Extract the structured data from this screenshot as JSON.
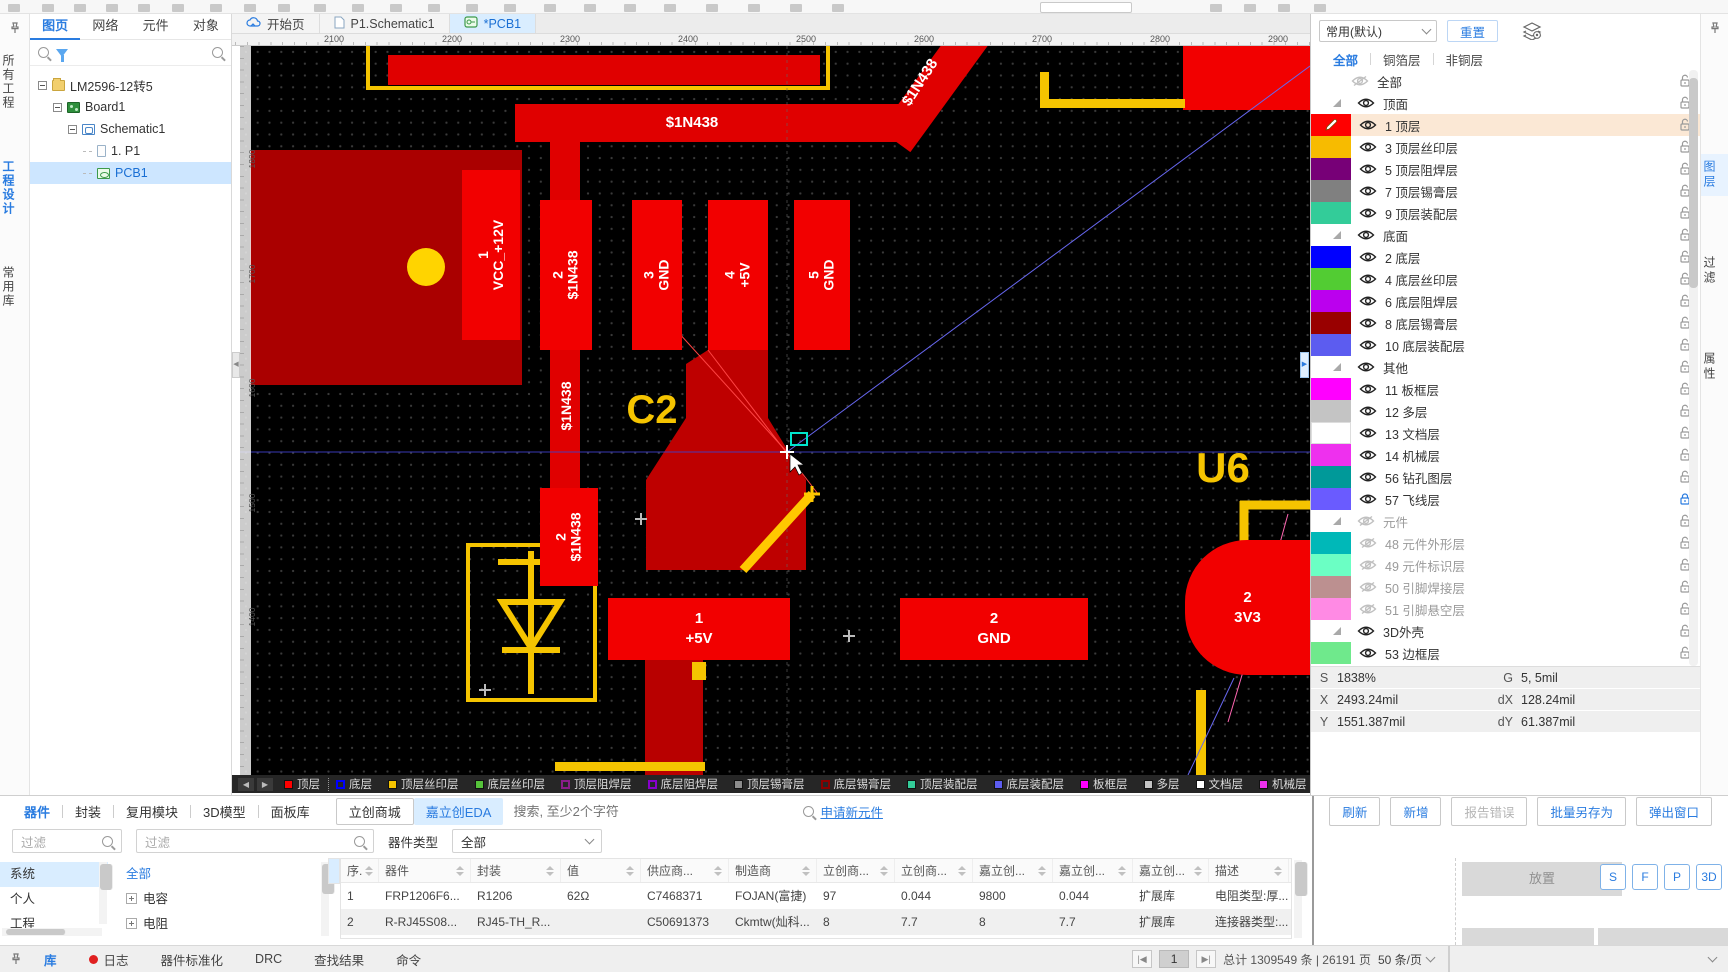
{
  "doc_tabs": [
    {
      "label": "开始页",
      "icon": "cloud-icon",
      "active": false
    },
    {
      "label": "P1.Schematic1",
      "icon": "schematic-doc-icon",
      "active": false
    },
    {
      "label": "*PCB1",
      "icon": "pcb-doc-icon",
      "active": true
    }
  ],
  "left_rail": {
    "tabs": [
      "所有工程",
      "工程设计",
      "常用库"
    ],
    "active_index": 1
  },
  "left_panel": {
    "tabs": [
      "图页",
      "网络",
      "元件",
      "对象"
    ],
    "active_tab": 0,
    "tree": [
      {
        "label": "LM2596-12转5",
        "icon": "folder",
        "indent": 0,
        "expand": true
      },
      {
        "label": "Board1",
        "icon": "board",
        "indent": 1,
        "expand": true
      },
      {
        "label": "Schematic1",
        "icon": "sch",
        "indent": 2,
        "expand": true
      },
      {
        "label": "1. P1",
        "icon": "page",
        "indent": 3,
        "expand": false
      },
      {
        "label": "PCB1",
        "icon": "pcb",
        "indent": 3,
        "expand": false,
        "selected": true
      }
    ]
  },
  "canvas": {
    "ruler_x": [
      "2100",
      "2200",
      "2300",
      "2400",
      "2500",
      "2600",
      "2700",
      "2800",
      "2900"
    ],
    "ruler_y": [
      "1800",
      "1700",
      "1600",
      "1500",
      "1400"
    ],
    "colors": {
      "copper": "#F20000",
      "pour": "#AA0000",
      "silk": "#F5C400",
      "via": "#FFD400"
    },
    "labels": [
      {
        "text": "$1N438",
        "x": 392,
        "y": 68,
        "size": 15,
        "color": "#fff",
        "rot": 0,
        "w": 120,
        "bold": true
      },
      {
        "text": "$1N438",
        "x": 630,
        "y": 28,
        "size": 15,
        "color": "#fff",
        "rot": -57,
        "w": 100,
        "bold": true
      },
      {
        "text": "$1N438",
        "x": 266,
        "y": 352,
        "size": 14,
        "color": "#fff",
        "rot": -90,
        "w": 120,
        "bold": true
      },
      {
        "text": "C2",
        "x": 372,
        "y": 342,
        "size": 40,
        "color": "#F5C400",
        "rot": 0,
        "w": 80,
        "bold": true
      },
      {
        "text": "U6",
        "x": 938,
        "y": 398,
        "size": 42,
        "color": "#F5C400",
        "rot": 0,
        "w": 90,
        "bold": true
      }
    ],
    "pads": [
      {
        "x": 222,
        "y": 124,
        "w": 58,
        "h": 170,
        "dir": "v",
        "lines": [
          "1",
          "VCC_+12V"
        ]
      },
      {
        "x": 300,
        "y": 154,
        "w": 52,
        "h": 150,
        "dir": "v",
        "lines": [
          "2",
          "$1N438"
        ]
      },
      {
        "x": 392,
        "y": 154,
        "w": 50,
        "h": 150,
        "dir": "v",
        "lines": [
          "3",
          "GND"
        ]
      },
      {
        "x": 468,
        "y": 154,
        "w": 60,
        "h": 150,
        "dir": "v",
        "lines": [
          "4",
          "+5V"
        ]
      },
      {
        "x": 554,
        "y": 154,
        "w": 56,
        "h": 150,
        "dir": "v",
        "lines": [
          "5",
          "GND"
        ]
      },
      {
        "x": 300,
        "y": 442,
        "w": 58,
        "h": 98,
        "dir": "v",
        "lines": [
          "2",
          "$1N438"
        ]
      },
      {
        "x": 368,
        "y": 552,
        "w": 182,
        "h": 62,
        "dir": "h",
        "lines": [
          "1",
          "+5V"
        ]
      },
      {
        "x": 660,
        "y": 552,
        "w": 188,
        "h": 62,
        "dir": "h",
        "lines": [
          "2",
          "GND"
        ]
      },
      {
        "x": 945,
        "y": 494,
        "w": 125,
        "h": 135,
        "dir": "h",
        "round": true,
        "lines": [
          "2",
          "3V3"
        ]
      }
    ],
    "layer_chips": [
      {
        "label": "顶层",
        "color": "#FF0000",
        "hollow": false,
        "active": true
      },
      {
        "label": "底层",
        "color": "#0000FF",
        "hollow": true,
        "active": false
      },
      {
        "label": "顶层丝印层",
        "color": "#F5C400",
        "hollow": false,
        "active": false
      },
      {
        "label": "底层丝印层",
        "color": "#55C23A",
        "hollow": false,
        "active": false
      },
      {
        "label": "顶层阻焊层",
        "color": "#8A1D8A",
        "hollow": true,
        "active": false
      },
      {
        "label": "底层阻焊层",
        "color": "#8800CC",
        "hollow": true,
        "active": false
      },
      {
        "label": "顶层锡膏层",
        "color": "#8C8C8C",
        "hollow": false,
        "active": false
      },
      {
        "label": "底层锡膏层",
        "color": "#8B0000",
        "hollow": true,
        "active": false
      },
      {
        "label": "顶层装配层",
        "color": "#33CC99",
        "hollow": false,
        "active": false
      },
      {
        "label": "底层装配层",
        "color": "#5C5CF0",
        "hollow": false,
        "active": false
      },
      {
        "label": "板框层",
        "color": "#FF00FF",
        "hollow": false,
        "active": false
      },
      {
        "label": "多层",
        "color": "#C4C4C4",
        "hollow": false,
        "active": false
      },
      {
        "label": "文档层",
        "color": "#FFFFFF",
        "hollow": false,
        "active": false
      },
      {
        "label": "机械层",
        "color": "#EE30EE",
        "hollow": false,
        "active": false
      },
      {
        "label": "3D",
        "color": "#66EE88",
        "hollow": false,
        "active": false
      }
    ]
  },
  "right_panel": {
    "preset": "常用(默认)",
    "reset": "重置",
    "tabs": [
      "全部",
      "铜箔层",
      "非铜层"
    ],
    "active_tab": 0,
    "rows": [
      {
        "type": "plain",
        "label": "全部",
        "visible": false,
        "lock": "open"
      },
      {
        "type": "group",
        "label": "顶面",
        "visible": true,
        "lock": "open"
      },
      {
        "type": "layer",
        "num": "1",
        "label": "顶层",
        "color": "#FF0000",
        "visible": true,
        "lock": "open",
        "active": true
      },
      {
        "type": "layer",
        "num": "3",
        "label": "顶层丝印层",
        "color": "#F7BB00",
        "visible": true,
        "lock": "open"
      },
      {
        "type": "layer",
        "num": "5",
        "label": "顶层阻焊层",
        "color": "#770077",
        "visible": true,
        "lock": "open"
      },
      {
        "type": "layer",
        "num": "7",
        "label": "顶层锡膏层",
        "color": "#808080",
        "visible": true,
        "lock": "open"
      },
      {
        "type": "layer",
        "num": "9",
        "label": "顶层装配层",
        "color": "#33CC99",
        "visible": true,
        "lock": "open"
      },
      {
        "type": "group",
        "label": "底面",
        "visible": true,
        "lock": "open"
      },
      {
        "type": "layer",
        "num": "2",
        "label": "底层",
        "color": "#0000FF",
        "visible": true,
        "lock": "open"
      },
      {
        "type": "layer",
        "num": "4",
        "label": "底层丝印层",
        "color": "#52CC33",
        "visible": true,
        "lock": "open"
      },
      {
        "type": "layer",
        "num": "6",
        "label": "底层阻焊层",
        "color": "#BB00EE",
        "visible": true,
        "lock": "open"
      },
      {
        "type": "layer",
        "num": "8",
        "label": "底层锡膏层",
        "color": "#990000",
        "visible": true,
        "lock": "open"
      },
      {
        "type": "layer",
        "num": "10",
        "label": "底层装配层",
        "color": "#5C5CF0",
        "visible": true,
        "lock": "open"
      },
      {
        "type": "group",
        "label": "其他",
        "visible": true,
        "lock": "open"
      },
      {
        "type": "layer",
        "num": "11",
        "label": "板框层",
        "color": "#FF00FF",
        "visible": true,
        "lock": "open"
      },
      {
        "type": "layer",
        "num": "12",
        "label": "多层",
        "color": "#C4C4C4",
        "visible": true,
        "lock": "open"
      },
      {
        "type": "layer",
        "num": "13",
        "label": "文档层",
        "color": "#FFFFFF",
        "visible": true,
        "lock": "open"
      },
      {
        "type": "layer",
        "num": "14",
        "label": "机械层",
        "color": "#EE30EE",
        "visible": true,
        "lock": "open"
      },
      {
        "type": "layer",
        "num": "56",
        "label": "钻孔图层",
        "color": "#009999",
        "visible": true,
        "lock": "open"
      },
      {
        "type": "layer",
        "num": "57",
        "label": "飞线层",
        "color": "#6A5BFF",
        "visible": true,
        "lock": "closed"
      },
      {
        "type": "group",
        "label": "元件",
        "visible": false,
        "lock": "open"
      },
      {
        "type": "layer",
        "num": "48",
        "label": "元件外形层",
        "color": "#00B8B8",
        "visible": false,
        "lock": "open"
      },
      {
        "type": "layer",
        "num": "49",
        "label": "元件标识层",
        "color": "#6BFFC4",
        "visible": false,
        "lock": "open"
      },
      {
        "type": "layer",
        "num": "50",
        "label": "引脚焊接层",
        "color": "#BC9090",
        "visible": false,
        "lock": "open"
      },
      {
        "type": "layer",
        "num": "51",
        "label": "引脚悬空层",
        "color": "#FF8AE4",
        "visible": false,
        "lock": "open"
      },
      {
        "type": "group",
        "label": "3D外壳",
        "visible": true,
        "lock": "open"
      },
      {
        "type": "layer",
        "num": "53",
        "label": "边框层",
        "color": "#6FE98C",
        "visible": true,
        "lock": "open"
      }
    ],
    "status": {
      "s_k": "S",
      "s_v": "1838%",
      "g_k": "G",
      "g_v": "5, 5mil",
      "x_k": "X",
      "x_v": "2493.24mil",
      "dx_k": "dX",
      "dx_v": "128.24mil",
      "y_k": "Y",
      "y_v": "1551.387mil",
      "dy_k": "dY",
      "dy_v": "61.387mil"
    }
  },
  "right_rail": {
    "tabs": [
      "图层",
      "过滤",
      "属性"
    ],
    "active_index": 0
  },
  "bottom_dock": {
    "tabs": [
      "器件",
      "封装",
      "复用模块",
      "3D模型",
      "面板库"
    ],
    "active_tab": 0,
    "shop_tab": "立创商城",
    "source_tab": "嘉立创EDA",
    "search_placeholder": "搜索, 至少2个字符",
    "apply_link": "申请新元件",
    "buttons": [
      {
        "label": "刷新",
        "disabled": false
      },
      {
        "label": "新增",
        "disabled": false
      },
      {
        "label": "报告错误",
        "disabled": true
      },
      {
        "label": "批量另存为",
        "disabled": false
      },
      {
        "label": "弹出窗口",
        "disabled": false
      }
    ],
    "filter1_placeholder": "过滤",
    "filter2_placeholder": "过滤",
    "type_label": "器件类型",
    "type_value": "全部",
    "list1": {
      "items": [
        "系统",
        "个人",
        "工程"
      ],
      "selected": 0
    },
    "list2": {
      "items": [
        "全部",
        "电容",
        "电阻"
      ],
      "selected": 0
    },
    "table": {
      "headers": [
        "序.",
        "器件",
        "封装",
        "值",
        "供应商...",
        "制造商",
        "立创商...",
        "立创商...",
        "嘉立创...",
        "嘉立创...",
        "嘉立创...",
        "描述"
      ],
      "rows": [
        [
          "1",
          "FRP1206F6...",
          "R1206",
          "62Ω",
          "C7468371",
          "FOJAN(富捷)",
          "97",
          "0.044",
          "9800",
          "0.044",
          "扩展库",
          "电阻类型:厚..."
        ],
        [
          "2",
          "R-RJ45S08...",
          "RJ45-TH_R...",
          "",
          "C50691373",
          "Ckmtw(灿科...",
          "8",
          "7.7",
          "8",
          "7.7",
          "扩展库",
          "连接器类型:..."
        ]
      ]
    },
    "place_panel": {
      "title": "放置",
      "modes": [
        "S",
        "F",
        "P",
        "3D"
      ]
    }
  },
  "status_bar": {
    "tabs": [
      "库",
      "日志",
      "器件标准化",
      "DRC",
      "查找结果",
      "命令"
    ],
    "active_tab": 0,
    "pagination": {
      "current": "1",
      "total": "总计 1309549 条 | 26191 页",
      "per_page": "50 条/页"
    }
  }
}
